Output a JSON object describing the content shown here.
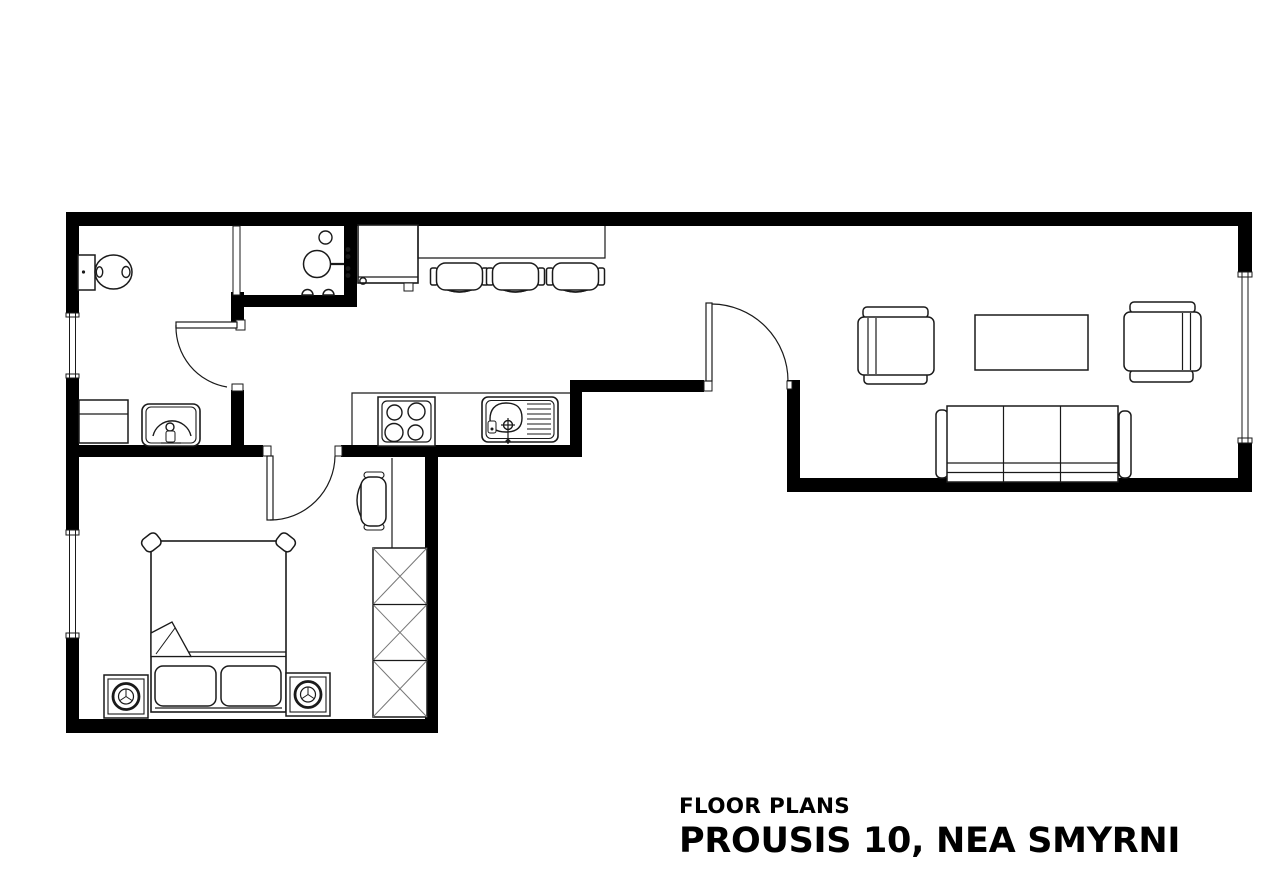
{
  "canvas": {
    "width": 1267,
    "height": 882
  },
  "colors": {
    "background": "#ffffff",
    "wall": "#000000",
    "line": "#1a1a1a",
    "detail": "#777777",
    "text": "#000000"
  },
  "caption": {
    "line1": "FLOOR PLANS",
    "line2": "PROUSIS 10, NEA SMYRNI"
  },
  "plan": {
    "type": "architectural-floor-plan",
    "style": "black-and-white line drawing",
    "rooms": [
      "bathroom",
      "shower-room",
      "hallway",
      "kitchen-dining",
      "living-room",
      "bedroom"
    ],
    "fixture_icons": [
      "toilet-icon",
      "shower-icon",
      "washbasin-icon",
      "cabinet-icon",
      "fridge-icon",
      "breakfast-counter-icon",
      "bar-chair-icon",
      "cooktop-icon",
      "kitchen-sink-icon",
      "armchair-icon",
      "coffee-table-icon",
      "sofa-icon",
      "double-bed-icon",
      "pillow-icon",
      "nightstand-lamp-icon",
      "wardrobe-icon",
      "desk-icon",
      "desk-chair-icon"
    ],
    "window_count": 3,
    "swing_door_count": 3
  }
}
